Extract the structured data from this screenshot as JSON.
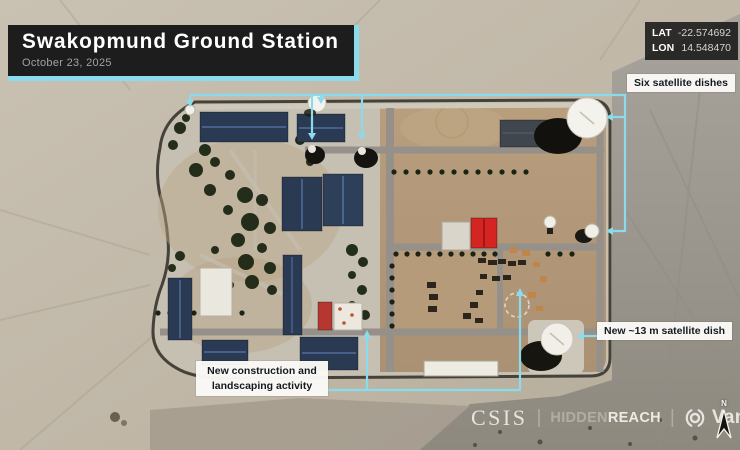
{
  "header": {
    "title": "Swakopmund Ground Station",
    "date": "October 23, 2025"
  },
  "coordinates": {
    "lat_label": "LAT",
    "lat_value": "-22.574692",
    "lon_label": "LON",
    "lon_value": "14.548470"
  },
  "callouts": {
    "six_dishes": "Six satellite dishes",
    "new_dish": "New ~13 m satellite dish",
    "new_construction": {
      "line1": "New construction and",
      "line2": "landscaping activity"
    }
  },
  "credits": {
    "csis": "CSIS",
    "hiddenreach": {
      "hidden": "HIDDEN",
      "reach": "REACH"
    },
    "vantor": "Vantor",
    "separator": "|"
  },
  "compass": {
    "north_label": "N"
  },
  "colors": {
    "accent_cyan": "#8adced",
    "callout_bg": "#faf9f6",
    "callout_text": "#141a20",
    "panel_bg": "#1d1d1d",
    "roof_navy": "#2a3a52",
    "roof_red": "#d42522"
  }
}
